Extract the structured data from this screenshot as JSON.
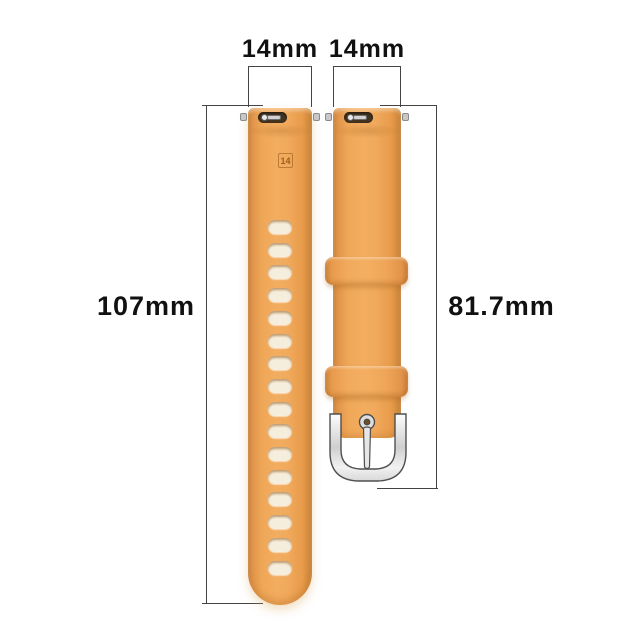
{
  "title": "watch-band-dimensions-diagram",
  "dimensions": {
    "left_strap_width": "14mm",
    "right_strap_width": "14mm",
    "left_strap_length": "107mm",
    "right_strap_length": "81.7mm"
  },
  "straps": {
    "left": {
      "emboss": "14",
      "hole_count": 16,
      "description": "long strap with adjustment holes"
    },
    "right": {
      "keeper_count": 2,
      "description": "short strap with keeper loops and pin buckle"
    }
  },
  "colors": {
    "strap": "#eca155",
    "hole": "#f6eedd",
    "buckle": "#e6e6e6",
    "line": "#444444",
    "text": "#111111"
  }
}
